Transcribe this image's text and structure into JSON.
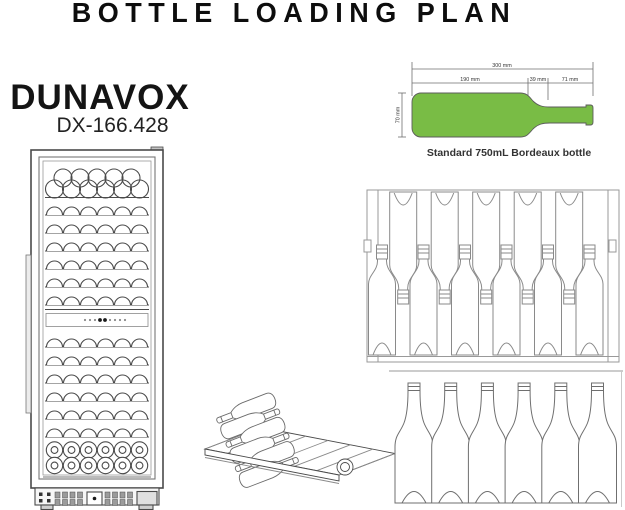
{
  "title": "BOTTLE LOADING PLAN",
  "brand": {
    "name": "DUNAVOX",
    "model": "DX-166.428"
  },
  "bordeaux_bottle": {
    "caption": "Standard 750mL Bordeaux bottle",
    "total_length": "300 mm",
    "body_length": "190 mm",
    "shoulder_length": "39 mm",
    "neck_length": "71 mm",
    "diameter": "70 mm",
    "fill_color": "#79bc45"
  },
  "colors": {
    "line": "#4a4a4a",
    "line_light": "#999999"
  },
  "bottle_counts": {
    "cooler_columns": 6,
    "cooler_top_stack": [
      5,
      6
    ],
    "cooler_upper_shelves": 6,
    "cooler_lower_shelves": 6,
    "cooler_bottom_stack": [
      6,
      6
    ],
    "control_dots": 9,
    "shelf_top_view_neck_up": 6,
    "shelf_top_view_neck_down": 5,
    "standing_bottles": 6,
    "isometric_bottles": 6
  }
}
